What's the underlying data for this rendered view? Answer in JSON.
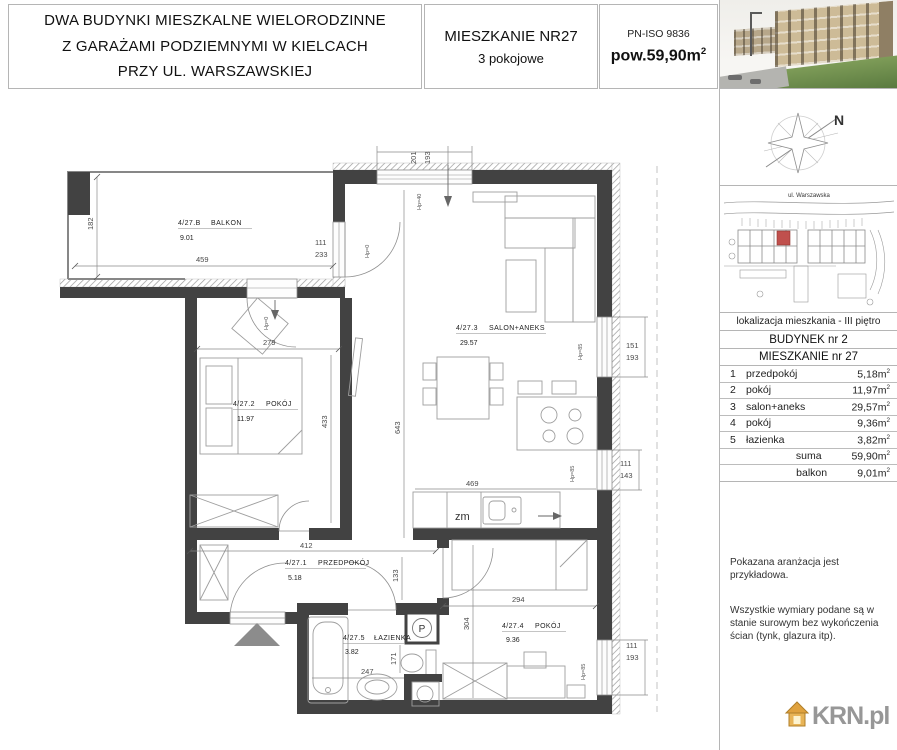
{
  "header": {
    "title_line1": "DWA BUDYNKI MIESZKALNE WIELORODZINNE",
    "title_line2": "Z GARAŻAMI PODZIEMNYMI W KIELCACH",
    "title_line3": "PRZY UL. WARSZAWSKIEJ",
    "apartment_no": "MIESZKANIE NR27",
    "apartment_type": "3 pokojowe",
    "norm": "PN-ISO 9836",
    "area_label": "pow.59,90m",
    "sup_2": "2"
  },
  "sidebar": {
    "compass_n": "N",
    "site_street": "ul. Warszawska",
    "location_line": "lokalizacja mieszkania - III piętro",
    "building_line": "BUDYNEK nr 2",
    "apartment_line": "MIESZKANIE nr 27",
    "sup_2": "2",
    "rooms": [
      {
        "no": "1",
        "name": "przedpokój",
        "area": "5,18m"
      },
      {
        "no": "2",
        "name": "pokój",
        "area": "11,97m"
      },
      {
        "no": "3",
        "name": "salon+aneks",
        "area": "29,57m"
      },
      {
        "no": "4",
        "name": "pokój",
        "area": "9,36m"
      },
      {
        "no": "5",
        "name": "łazienka",
        "area": "3,82m"
      }
    ],
    "summary": [
      {
        "name": "suma",
        "area": "59,90m"
      },
      {
        "name": "balkon",
        "area": "9,01m"
      }
    ],
    "note1": "Pokazana aranżacja jest przykładowa.",
    "note2": "Wszystkie wymiary podane są w stanie surowym bez wykończenia ścian (tynk, glazura itp).",
    "logo_text": "KRN.pl"
  },
  "plan": {
    "rooms": [
      {
        "id": "4/27.B",
        "name": "BALKON",
        "area": "9.01"
      },
      {
        "id": "4/27.2",
        "name": "POKÓJ",
        "area": "11.97"
      },
      {
        "id": "4/27.3",
        "name": "SALON+ANEKS",
        "area": "29.57"
      },
      {
        "id": "4/27.1",
        "name": "PRZEDPOKÓJ",
        "area": "5.18"
      },
      {
        "id": "4/27.5",
        "name": "ŁAZIENKA",
        "area": "3.82"
      },
      {
        "id": "4/27.4",
        "name": "POKÓJ",
        "area": "9.36"
      }
    ],
    "dims": {
      "d459": "459",
      "d182": "182",
      "d111a": "111",
      "d233": "233",
      "d201": "201",
      "d193a": "193",
      "d279": "279",
      "d433": "433",
      "d643": "643",
      "d151": "151",
      "d193b": "193",
      "d111b": "111",
      "d143": "143",
      "d469": "469",
      "d412": "412",
      "d133": "133",
      "d294": "294",
      "d304": "304",
      "d247": "247",
      "d171": "171",
      "d111c": "111",
      "d193c": "193"
    },
    "annotations": {
      "hp0": "Hp=0",
      "hp40": "Hp=40",
      "hp85": "Hp=85",
      "zm": "zm",
      "shaft": "P"
    }
  },
  "colors": {
    "wall": "#424242",
    "accent_red": "#c0504d",
    "logo_orange": "#e0a23e",
    "logo_gray": "#979797"
  }
}
